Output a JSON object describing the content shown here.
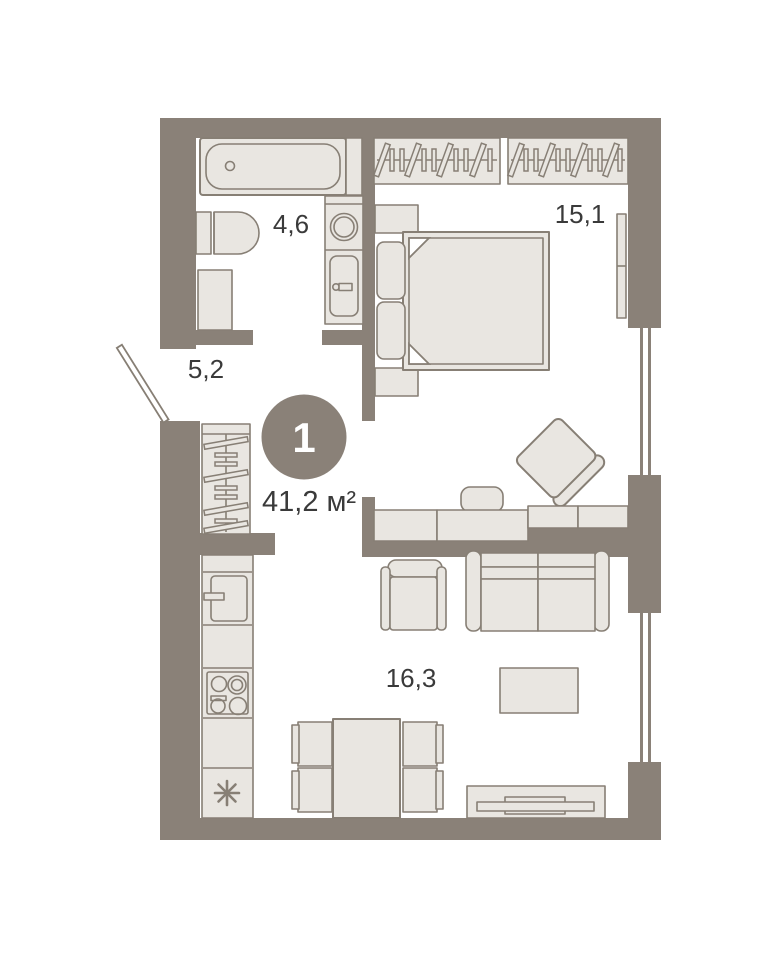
{
  "plan": {
    "apartment_badge": {
      "rooms_count": "1",
      "total_area": "41,2 м²"
    },
    "rooms": [
      {
        "name": "bathroom",
        "area": "4,6"
      },
      {
        "name": "bedroom",
        "area": "15,1"
      },
      {
        "name": "hallway",
        "area": "5,2"
      },
      {
        "name": "living-kitchen",
        "area": "16,3"
      }
    ],
    "colors": {
      "wall": "#8a8178",
      "furniture_fill": "#e9e6e1",
      "furniture_stroke": "#877f75",
      "text": "#3a3a3a",
      "badge_bg": "#8a8178",
      "badge_text": "#ffffff"
    }
  }
}
